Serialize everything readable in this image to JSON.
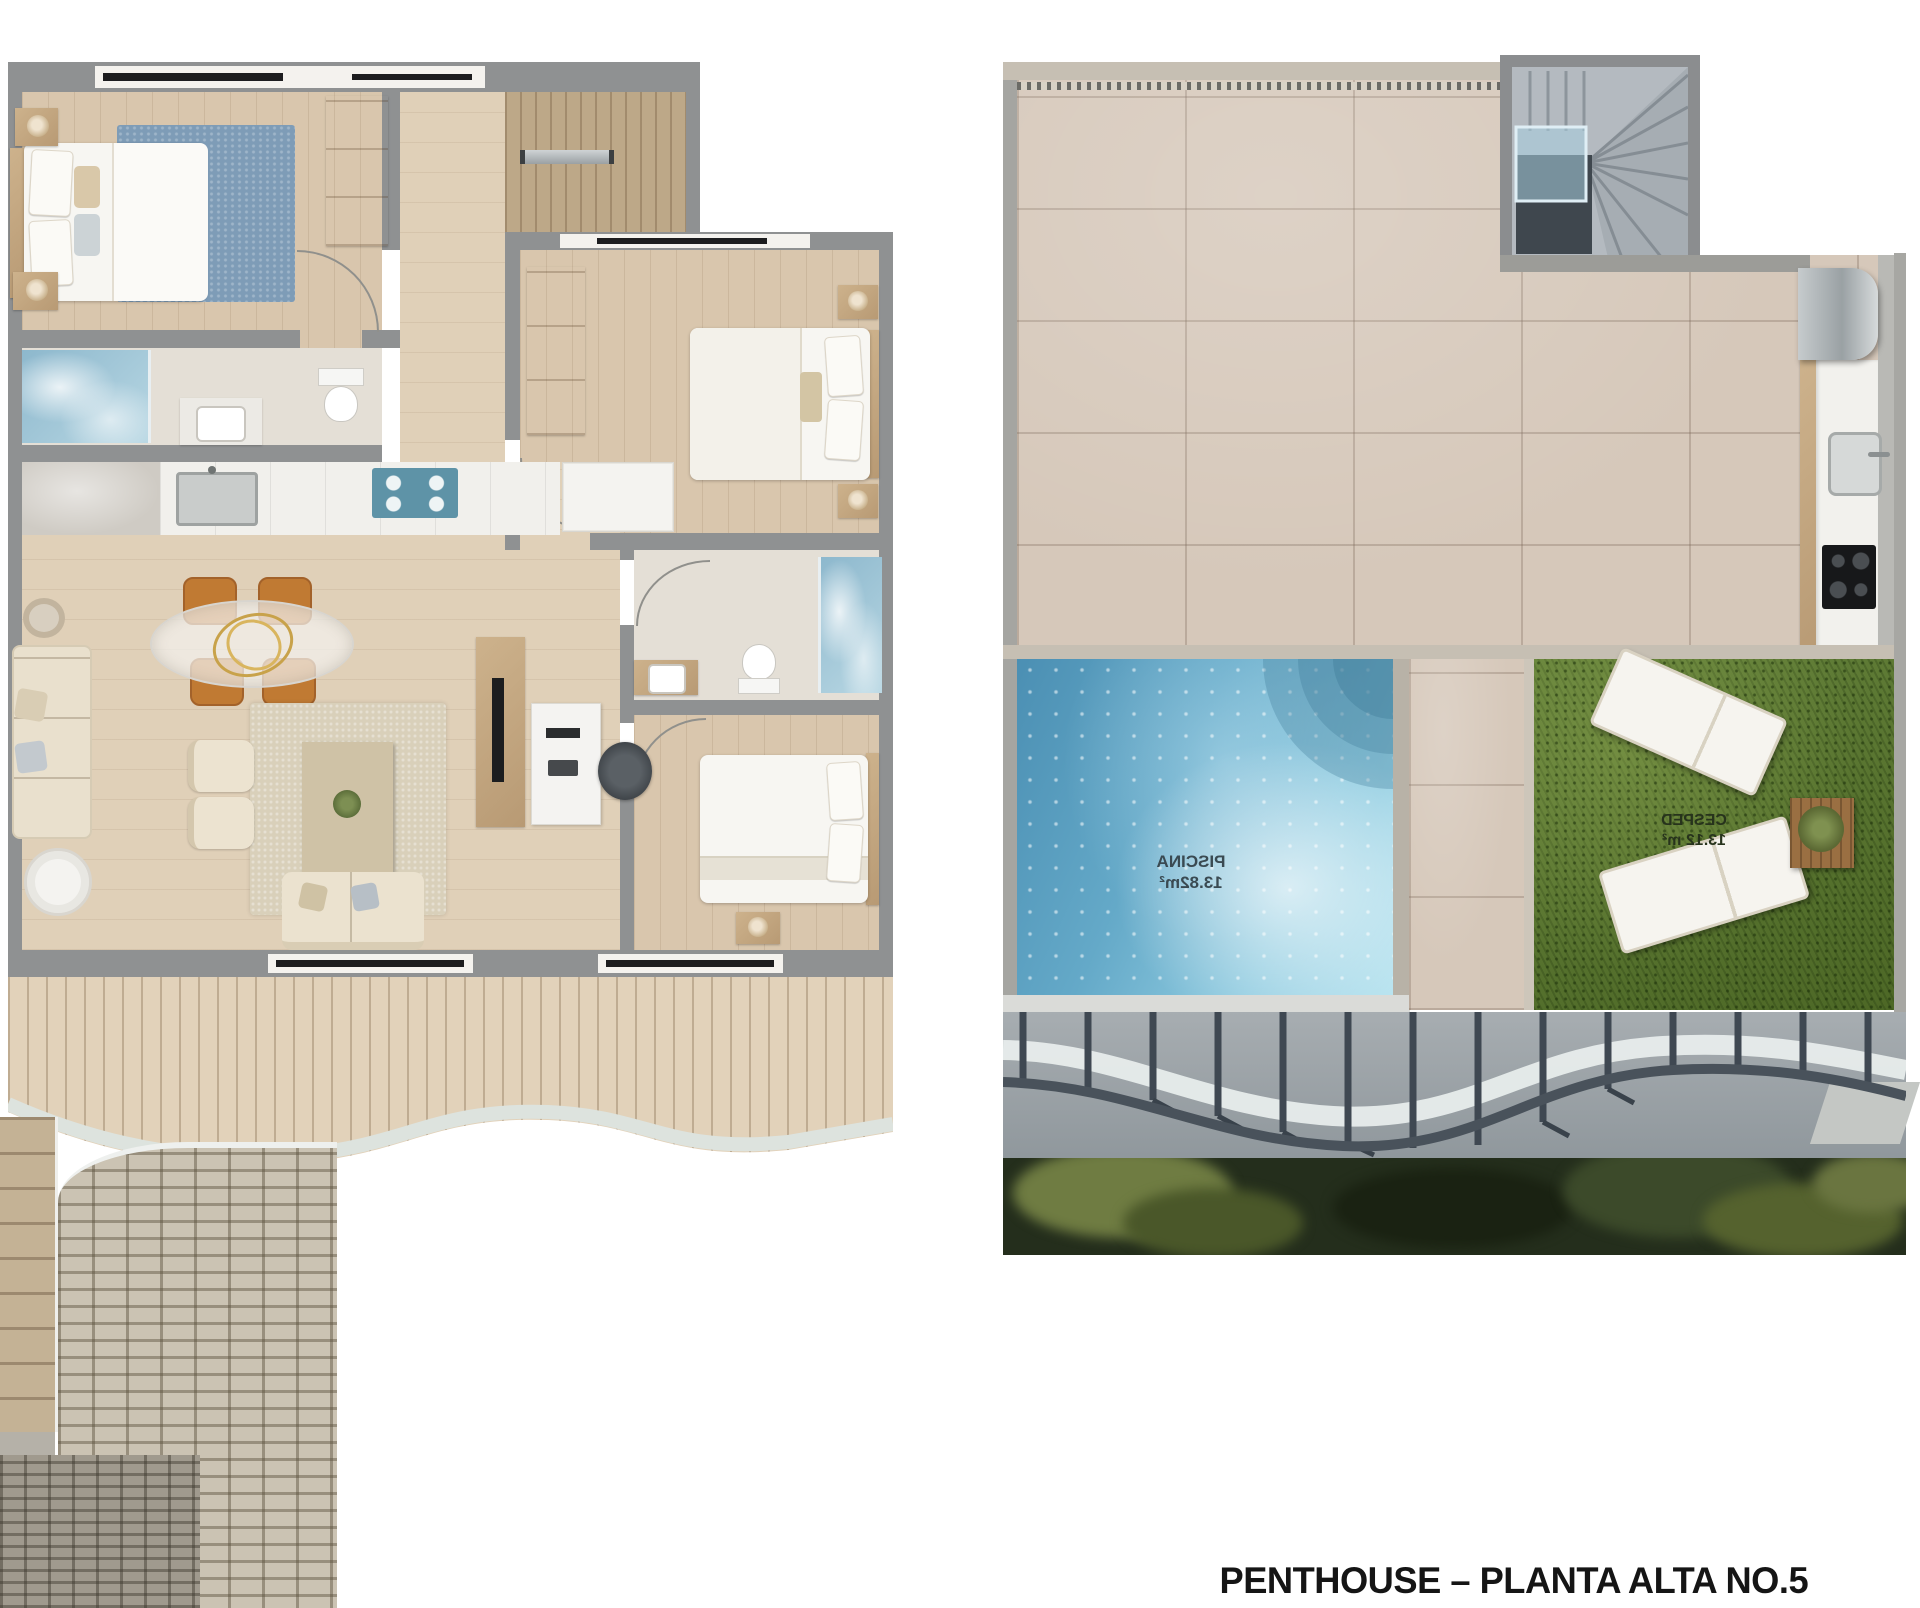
{
  "caption": {
    "text": "PENTHOUSE – PLANTA ALTA NO.5"
  },
  "rooftop_plan": {
    "pool_label": {
      "name": "PISCINA",
      "area": "13.82m²",
      "mirrored": true
    },
    "lawn_label": {
      "name": "CESPED",
      "area": "13.12 m²",
      "mirrored": true
    }
  },
  "palette": {
    "pool_blue": "#5fa6c4",
    "grass_green": "#5c7a2f",
    "wall_gray": "#8f9192",
    "wood_floor": "#d9c6ad",
    "deck_wood": "#e2d2ba",
    "terrace_tile": "#d6c8ba",
    "caption_black": "#151515"
  }
}
